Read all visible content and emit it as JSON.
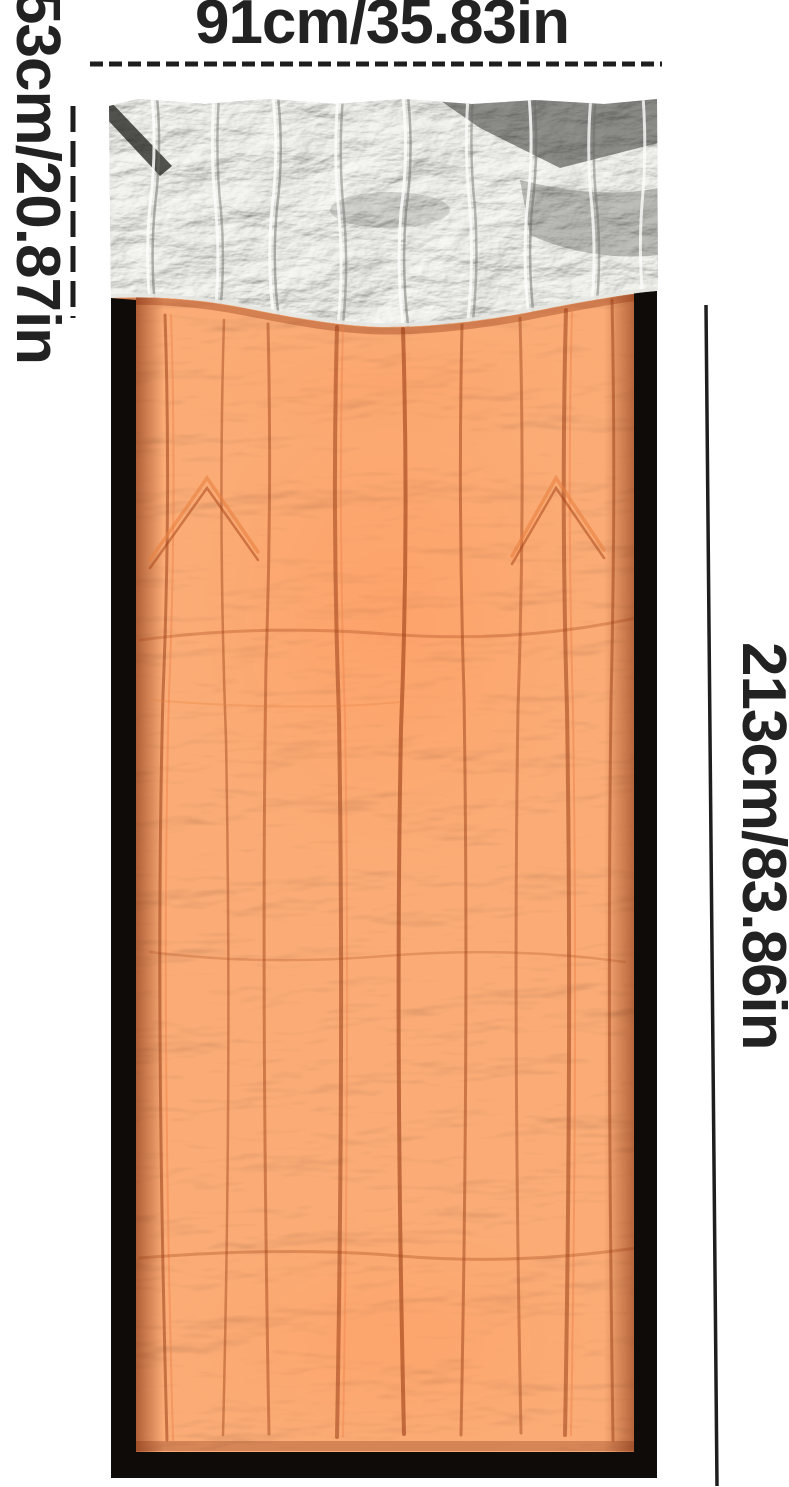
{
  "annotations": {
    "width_label": "91cm/35.83in",
    "hood_label": "53cm/20.87in",
    "length_label": "213cm/83.86in"
  },
  "colors": {
    "background": "#ffffff",
    "annotation_text": "#222222",
    "dimension_line": "#1e1e1e",
    "bag_orange": "#cc4e24",
    "bag_orange_highlight": "#e8763d",
    "bag_orange_shadow": "#93350f",
    "bag_edge_black": "#0e0b09",
    "foil_silver": "#b9b9b7",
    "foil_highlight": "#f2f2ee",
    "foil_shadow": "#3c3c3a"
  }
}
